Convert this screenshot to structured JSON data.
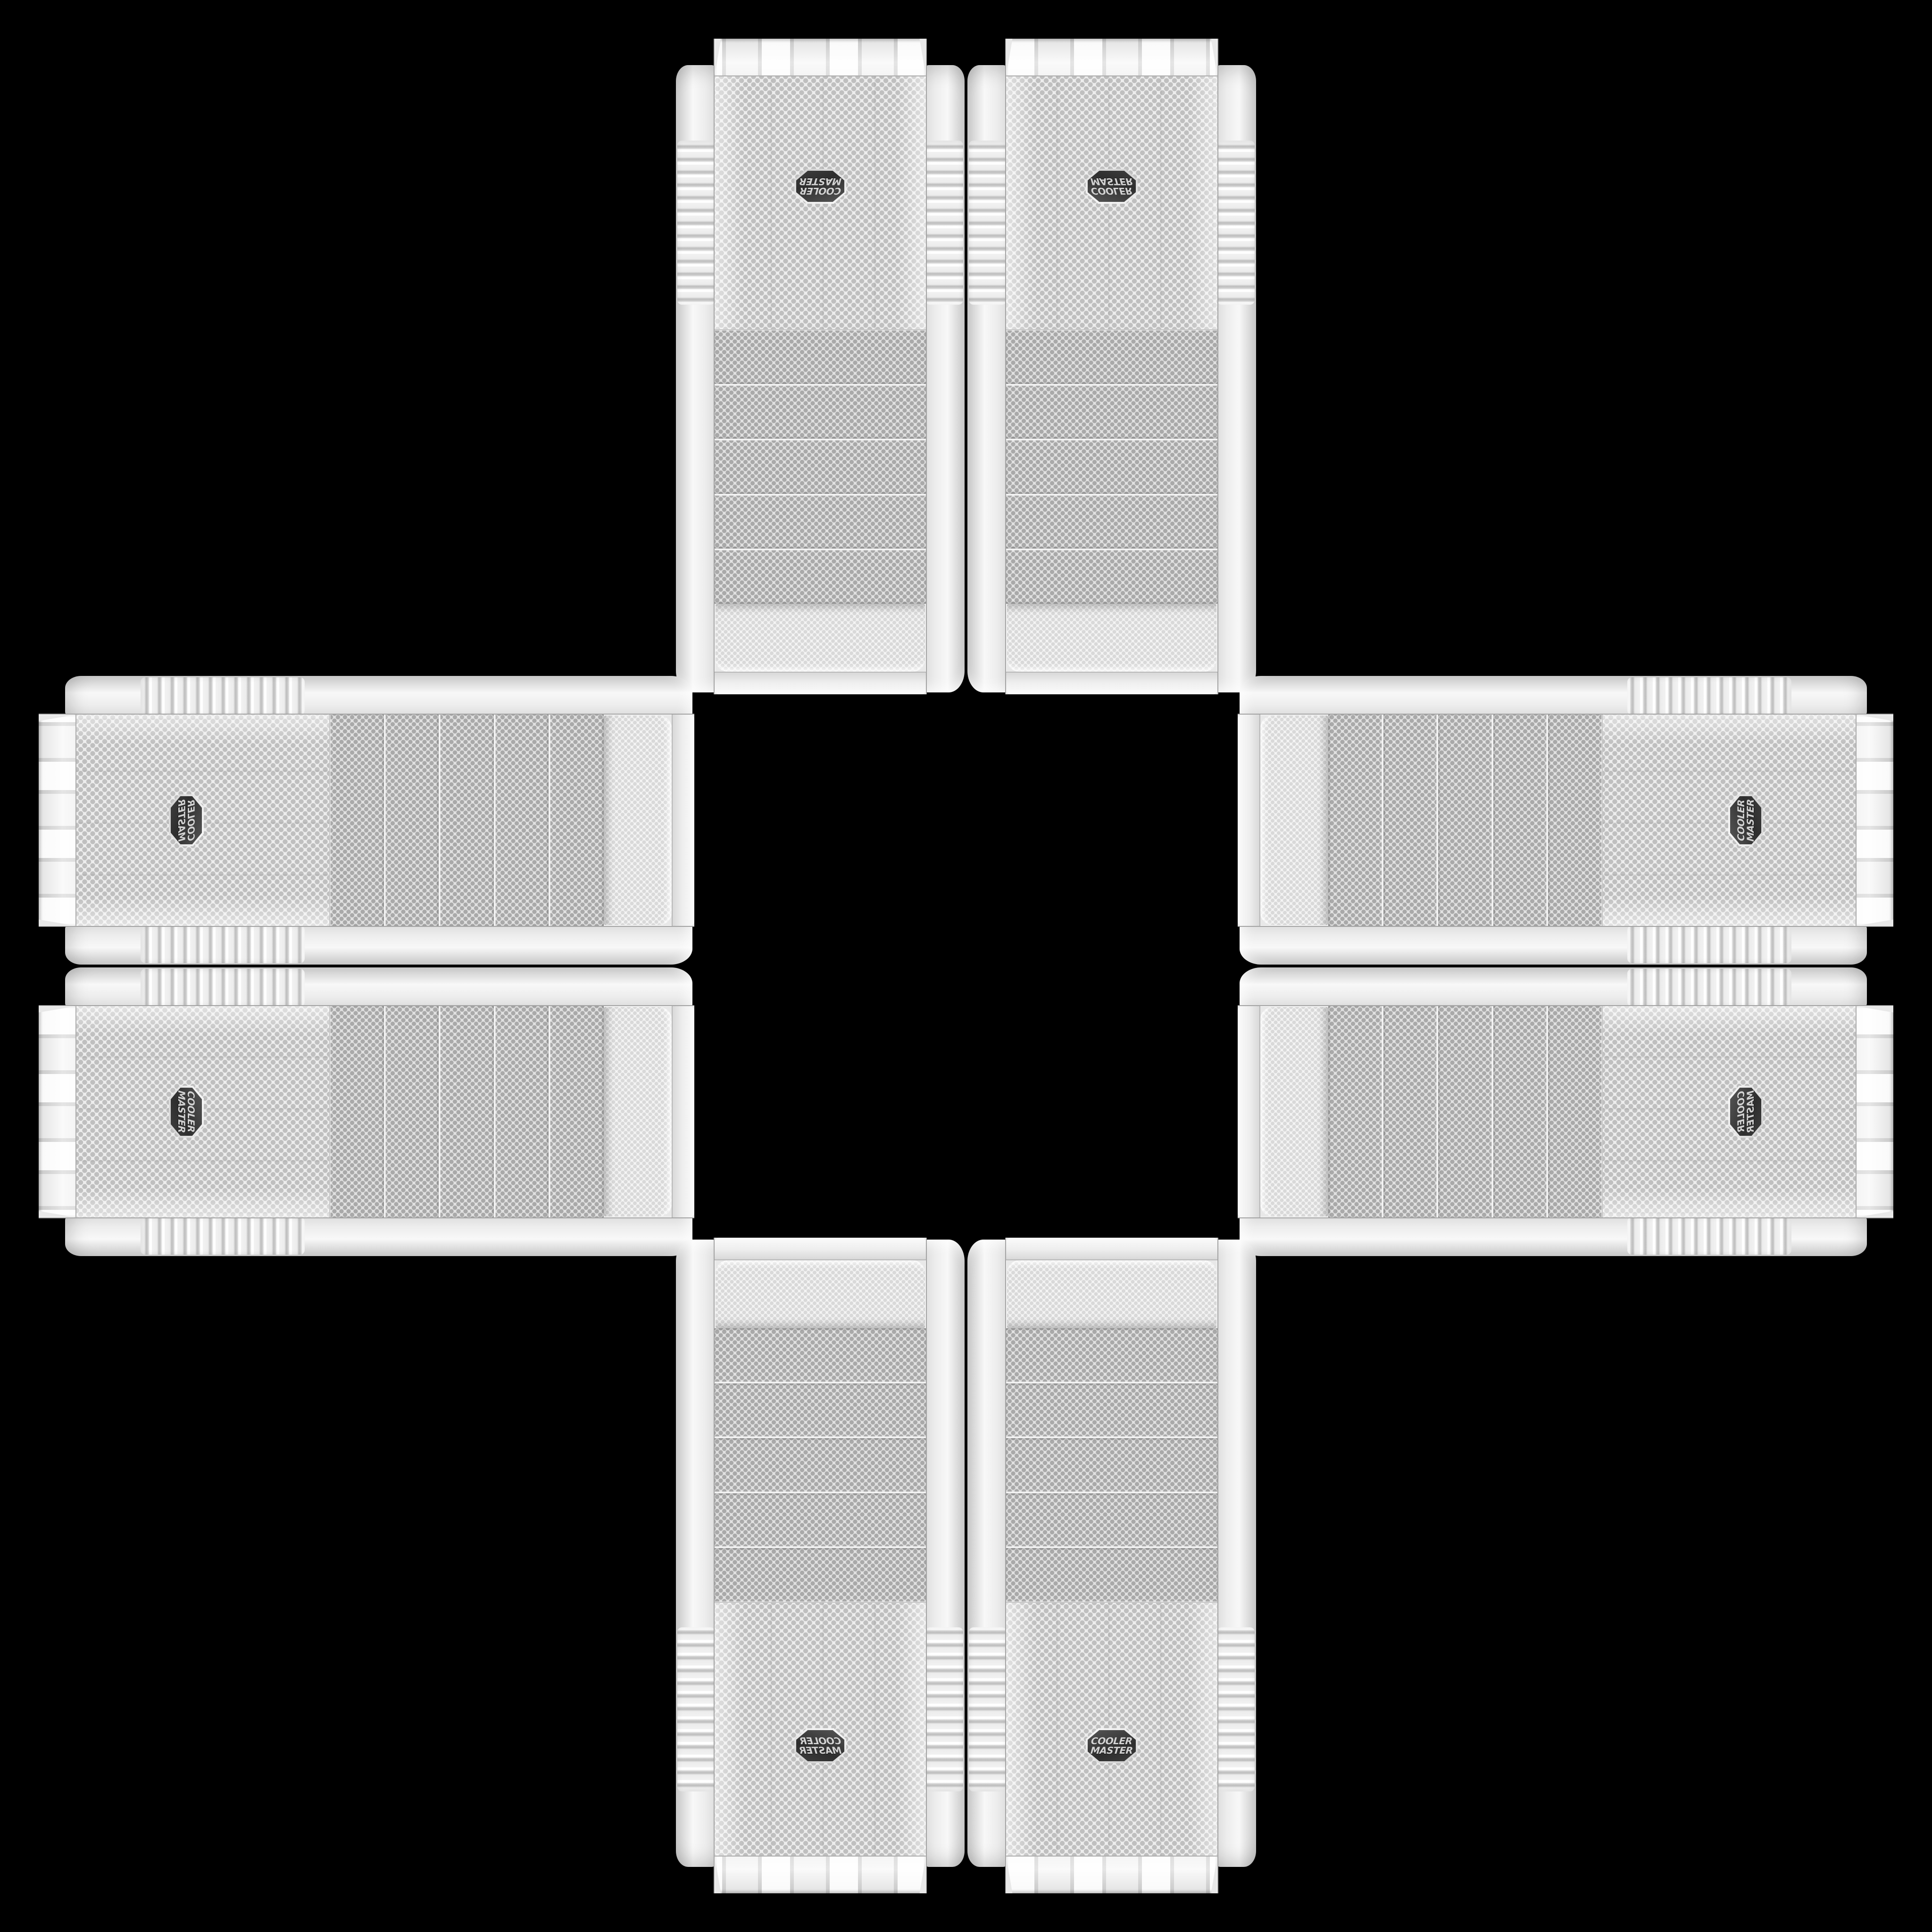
{
  "scene": {
    "type": "product-photo-collage",
    "background_color": "#000000",
    "pattern": "plus-cross",
    "case_count": 8,
    "description": "Eight identical white Cooler Master mid-tower PC case front panels arranged in a symmetric plus/cross pattern on a black background, mirrored and rotated pairwise so all badges face outward"
  },
  "badge": {
    "line1": "COOLER",
    "line2": "MASTER",
    "plate_color": "#2e2e2e",
    "rim_color": "#e8e8e8",
    "text_color": "#d2d2d2"
  },
  "case": {
    "finish": "white",
    "body_color": "#ececec",
    "mesh_dot_color": "#b9b9b9",
    "rail_rib_color": "#cfcfcf",
    "drive_bay_count": 5,
    "panel_sections": [
      "top-cap",
      "mesh-bulge",
      "drive-bay-covers",
      "fan-mesh-with-badge",
      "bottom-cap"
    ]
  },
  "cases": [
    {
      "id": "case-top-left",
      "slot": "top-arm-left",
      "orientation": "rotated-180"
    },
    {
      "id": "case-top-right",
      "slot": "top-arm-right",
      "orientation": "flipped-vertical"
    },
    {
      "id": "case-left-top",
      "slot": "left-arm-top",
      "orientation": "rotated-90ccw-mirrored"
    },
    {
      "id": "case-left-bottom",
      "slot": "left-arm-bottom",
      "orientation": "rotated-90cw"
    },
    {
      "id": "case-right-top",
      "slot": "right-arm-top",
      "orientation": "rotated-90ccw"
    },
    {
      "id": "case-right-bottom",
      "slot": "right-arm-bottom",
      "orientation": "rotated-90ccw-flipped"
    },
    {
      "id": "case-bottom-left",
      "slot": "bottom-arm-left",
      "orientation": "mirrored-horizontal"
    },
    {
      "id": "case-bottom-right",
      "slot": "bottom-arm-right",
      "orientation": "upright"
    }
  ]
}
